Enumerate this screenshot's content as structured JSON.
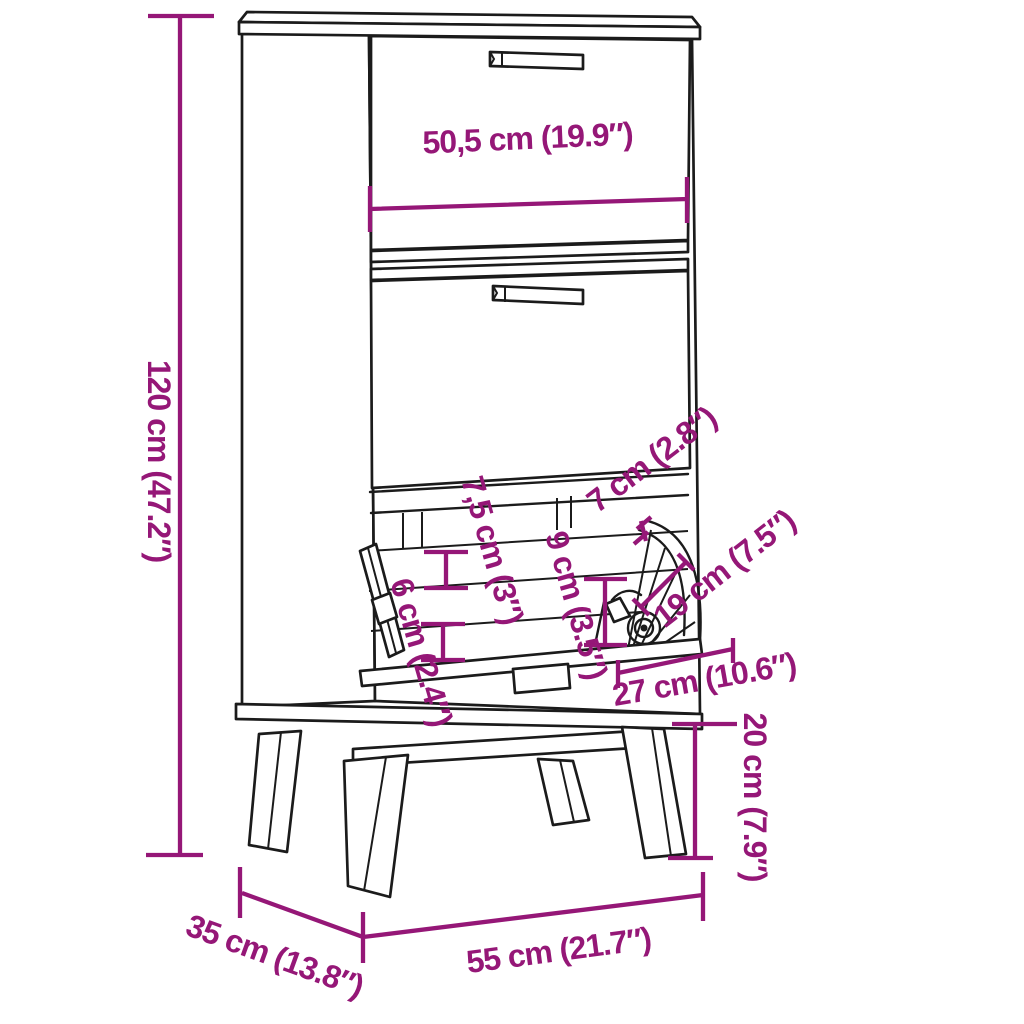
{
  "diagram": {
    "type": "furniture-dimension-diagram",
    "subject": "shoe cabinet with two flip-down drawers, open bottom flap with shoe, splayed legs",
    "colors": {
      "accent": "#951777",
      "line": "#1b1b1b",
      "background": "#ffffff"
    },
    "dimensions": {
      "top_width": "50,5 cm (19.9″)",
      "height": "120 cm (47.2″)",
      "rail_height": "7,5 cm (3″)",
      "flap_gap": "7 cm (2.8″)",
      "pocket_height": "9 cm (3.5″)",
      "lower_pocket_height": "6 cm (2.4″)",
      "flap_depth": "19 cm (7.5″)",
      "flap_opening_width": "27 cm (10.6″)",
      "leg_height": "20 cm (7.9″)",
      "bottom_width": "55 cm (21.7″)",
      "depth": "35 cm (13.8″)"
    }
  }
}
